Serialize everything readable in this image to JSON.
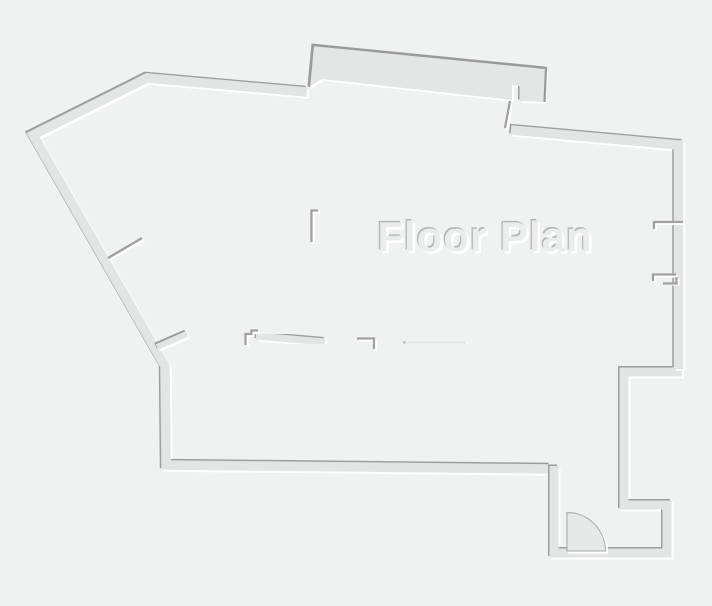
{
  "title": "Floor Plan",
  "canvas": {
    "width": 712,
    "height": 606
  },
  "colors": {
    "background": "#f0f1f1",
    "wall_band": "#e3e5e5",
    "slab_fill": "#e4e6e6",
    "edge_dark": "#9d9d9d",
    "edge_light": "#ffffff",
    "thin_wall": "#a0a0a0",
    "slab_outline": "#9a9a9a",
    "door_fill": "#e7e9e9",
    "door_arc": "#b3b5b5",
    "title_body": "#ebecec",
    "title_dark": "#b5b6b6",
    "title_light": "#ffffff"
  },
  "title_style": {
    "x": 485,
    "y": 251,
    "size": 42,
    "dark_offset": [
      -1.3,
      -1.3
    ],
    "light_offset": [
      2.4,
      2.6
    ]
  },
  "floor_plan": {
    "slab": {
      "id": "top-bump-slab",
      "points": [
        [
          309,
          87
        ],
        [
          313,
          45
        ],
        [
          546,
          68
        ],
        [
          544.5,
          102
        ],
        [
          519.5,
          101
        ],
        [
          519.5,
          86
        ],
        [
          512,
          85.5
        ],
        [
          512,
          100
        ],
        [
          322,
          79
        ]
      ]
    },
    "slab_outline_points": [
      [
        309,
        87
      ],
      [
        313,
        45
      ],
      [
        546,
        68
      ],
      [
        544.5,
        102
      ]
    ],
    "walls_thick": [
      {
        "id": "outer-left-top-bottom",
        "w": 9.5,
        "points": [
          [
            307,
            92
          ],
          [
            147,
            78
          ],
          [
            33,
            135
          ],
          [
            165,
            366
          ],
          [
            166,
            465
          ],
          [
            550,
            469
          ]
        ]
      },
      {
        "id": "entry-step-stub",
        "w": 7,
        "points": [
          [
            553,
            437
          ],
          [
            553,
            469
          ]
        ]
      },
      {
        "id": "outer-bottom-right-corridor",
        "w": 9,
        "points": [
          [
            554,
            466
          ],
          [
            554,
            553
          ],
          [
            667,
            553
          ],
          [
            667,
            505
          ],
          [
            624,
            505
          ],
          [
            624,
            372
          ],
          [
            682,
            372
          ]
        ]
      },
      {
        "id": "outer-right-diagonal",
        "w": 9.5,
        "points": [
          [
            678.5,
            369
          ],
          [
            678.5,
            145
          ],
          [
            511,
            130
          ]
        ]
      },
      {
        "id": "hall-thick-wall",
        "w": 21,
        "points": [
          [
            227,
            89
          ],
          [
            227,
            243
          ]
        ]
      },
      {
        "id": "mid-wall-segment-4",
        "w": 8,
        "points": [
          [
            405,
            342
          ],
          [
            466,
            343
          ]
        ]
      },
      {
        "id": "mid-wall-segment-2",
        "w": 7,
        "points": [
          [
            256,
            336
          ],
          [
            325,
            342
          ]
        ]
      },
      {
        "id": "mid-wall-angled",
        "w": 6,
        "points": [
          [
            157,
            347
          ],
          [
            187,
            334
          ]
        ]
      },
      {
        "id": "mid-wall-segment-1",
        "w": 6,
        "points": [
          [
            189,
            342
          ],
          [
            211,
            342
          ]
        ]
      },
      {
        "id": "room-divider-3",
        "w": 11,
        "points": [
          [
            460,
            360
          ],
          [
            460,
            465
          ]
        ]
      }
    ],
    "walls_thin": [
      {
        "id": "slab-connector",
        "points": [
          [
            510,
            101
          ],
          [
            505,
            128
          ]
        ]
      },
      {
        "id": "hall-wall-tail",
        "points": [
          [
            215.5,
            244
          ],
          [
            215.5,
            280
          ]
        ]
      },
      {
        "id": "bath-top-wall",
        "points": [
          [
            238,
            242
          ],
          [
            313,
            242
          ]
        ]
      },
      {
        "id": "bath-right-wall",
        "points": [
          [
            318,
            210.5
          ],
          [
            311.5,
            210.5
          ],
          [
            311.5,
            242
          ]
        ]
      },
      {
        "id": "bath-stub-left",
        "points": [
          [
            249.5,
            252
          ],
          [
            249.5,
            302
          ]
        ]
      },
      {
        "id": "bath-stub-mid",
        "points": [
          [
            293,
            252
          ],
          [
            293,
            291
          ]
        ]
      },
      {
        "id": "bath-low-wall",
        "points": [
          [
            302,
            287
          ],
          [
            322,
            287
          ]
        ]
      },
      {
        "id": "left-angled-stub",
        "points": [
          [
            108,
            258
          ],
          [
            142,
            238
          ]
        ]
      },
      {
        "id": "mid-wall-step",
        "points": [
          [
            245.5,
            345
          ],
          [
            245.5,
            334
          ],
          [
            251.5,
            334
          ],
          [
            251.5,
            330.5
          ],
          [
            258,
            330.5
          ]
        ]
      },
      {
        "id": "mid-wall-segment-3",
        "points": [
          [
            357,
            338.5
          ],
          [
            374,
            338.5
          ],
          [
            374,
            349
          ]
        ]
      },
      {
        "id": "divider-3-stub",
        "points": [
          [
            438.5,
            339
          ],
          [
            438.5,
            361
          ]
        ]
      },
      {
        "id": "room-divider-1",
        "points": [
          [
            286.5,
            342
          ],
          [
            286.5,
            465
          ]
        ]
      },
      {
        "id": "room-divider-2",
        "points": [
          [
            360,
            344
          ],
          [
            360,
            465
          ]
        ]
      },
      {
        "id": "right-jamb-upper",
        "points": [
          [
            683,
            222
          ],
          [
            654,
            222
          ],
          [
            654,
            229
          ]
        ]
      },
      {
        "id": "right-jamb-middle",
        "points": [
          [
            676.5,
            231
          ],
          [
            676.5,
            273
          ]
        ]
      },
      {
        "id": "right-jamb-lower-a",
        "points": [
          [
            676,
            274.5
          ],
          [
            653,
            274.5
          ],
          [
            653,
            281
          ]
        ]
      },
      {
        "id": "right-jamb-lower-b",
        "points": [
          [
            663,
            283.5
          ],
          [
            676.5,
            283.5
          ],
          [
            676.5,
            277
          ]
        ]
      }
    ],
    "door": {
      "leaf": [
        [
          567,
          513
        ],
        [
          567,
          551
        ]
      ],
      "hinge": [
        567,
        551
      ],
      "radius": 38.5,
      "arc_start": [
        567,
        512.5
      ],
      "arc_end": [
        605.5,
        551
      ]
    }
  }
}
